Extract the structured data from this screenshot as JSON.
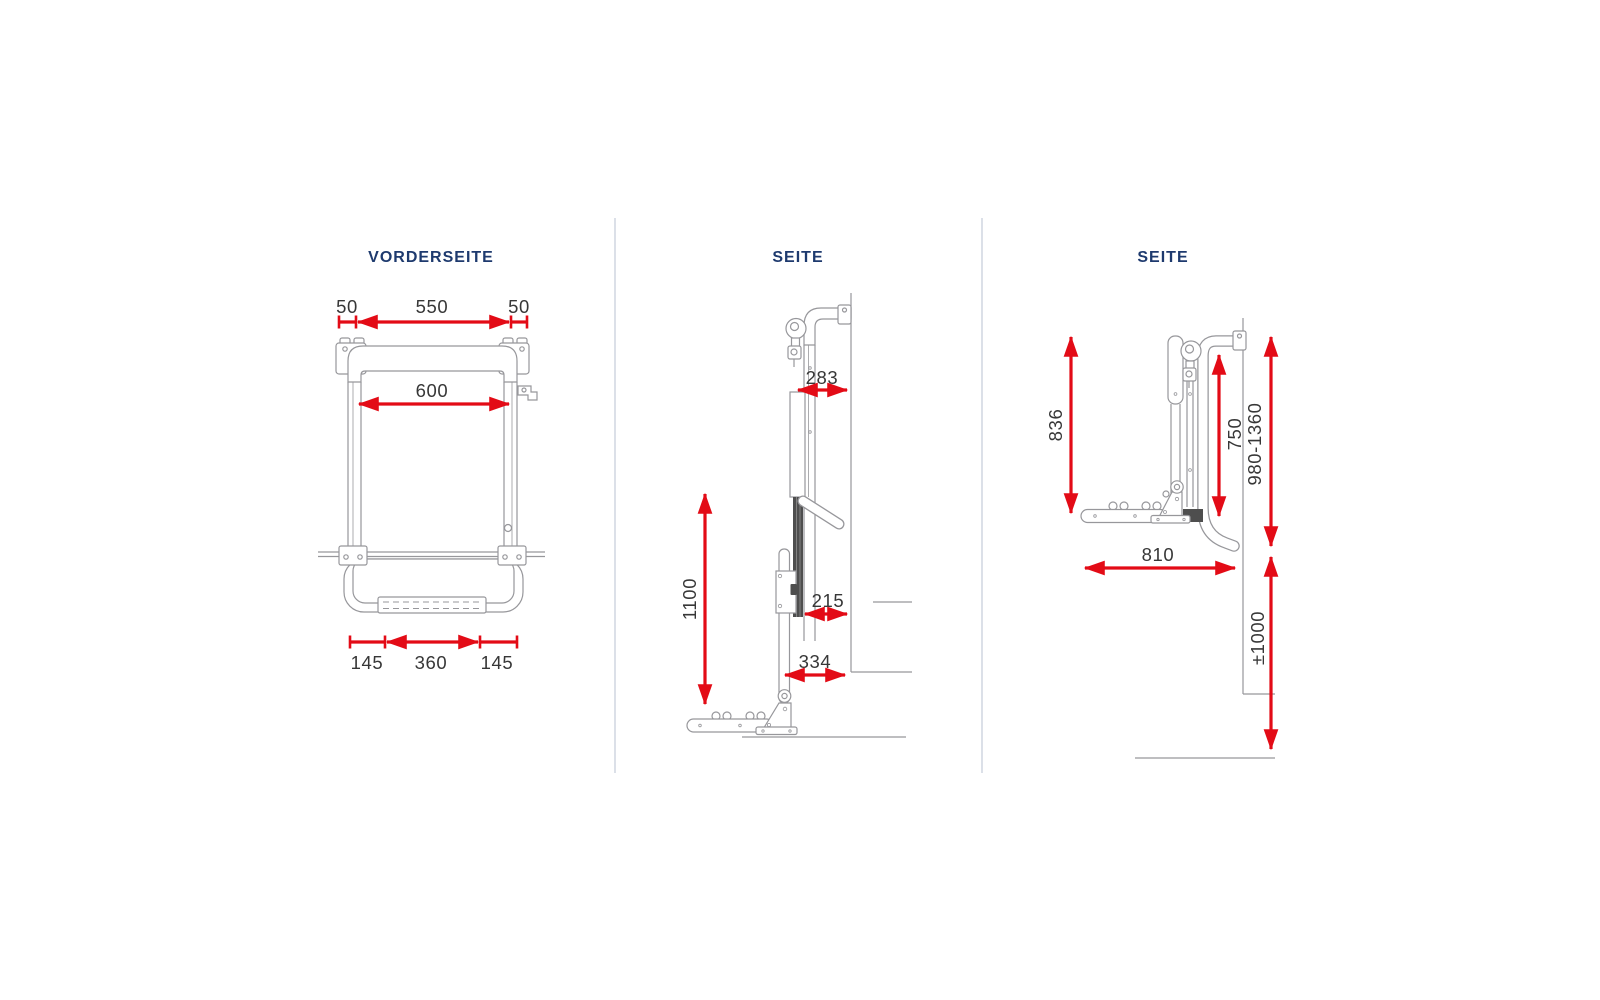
{
  "colors": {
    "dimension_red": "#e30b16",
    "title_navy": "#1e3a6e",
    "dimension_text": "#373737",
    "drawing_gray": "#97979b",
    "divider_gray": "#ccd2df"
  },
  "views": {
    "front": {
      "title": "VORDERSEITE",
      "dims": {
        "top_left_offset": "50",
        "top_span": "550",
        "top_right_offset": "50",
        "inner_width": "600",
        "bottom_left_offset": "145",
        "bottom_span": "360",
        "bottom_right_offset": "145"
      }
    },
    "side_lowered": {
      "title": "SEITE",
      "dims": {
        "upper_depth": "283",
        "height": "1100",
        "mid_depth": "215",
        "lower_depth": "334"
      }
    },
    "side_raised": {
      "title": "SEITE",
      "dims": {
        "rail_height": "836",
        "platform_height": "750",
        "mount_range": "980-1360",
        "depth": "810",
        "ground_distance": "±1000"
      }
    }
  }
}
